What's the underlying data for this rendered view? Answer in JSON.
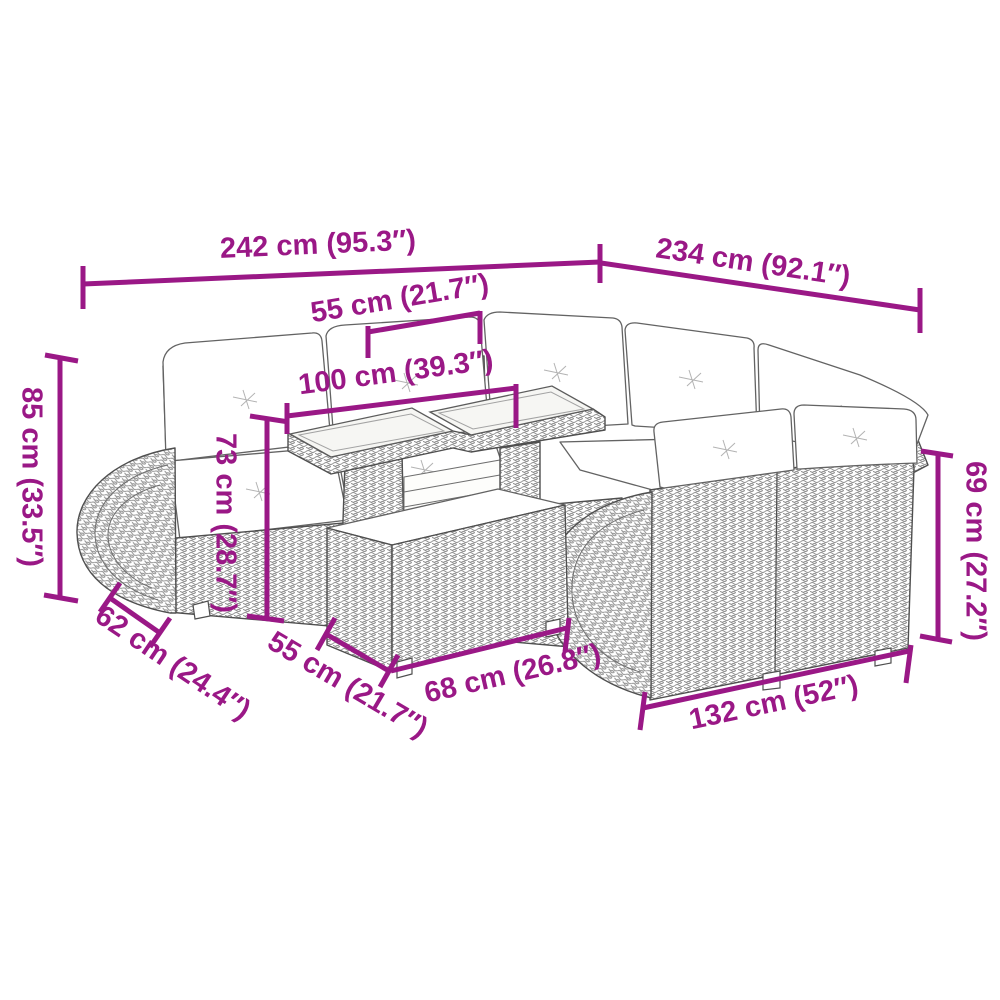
{
  "diagram": {
    "background_color": "#FFFFFF",
    "dimension_color": "#9A1886",
    "artwork_line_color": "#4F4F4F",
    "subject": "garden-corner-sofa-set-with-table-and-storage-box"
  },
  "dimensions": {
    "back_left_width": {
      "label": "242 cm (95.3″)"
    },
    "back_right_width": {
      "label": "234 cm (92.1″)"
    },
    "table_top_depth": {
      "label": "55 cm (21.7″)"
    },
    "table_top_width": {
      "label": "100 cm (39.3″)"
    },
    "sofa_height": {
      "label": "85 cm (33.5″)"
    },
    "table_height": {
      "label": "73 cm (28.7″)"
    },
    "right_sofa_height": {
      "label": "69 cm (27.2″)"
    },
    "left_sofa_depth": {
      "label": "62 cm (24.4″)"
    },
    "box_depth": {
      "label": "55 cm (21.7″)"
    },
    "box_width": {
      "label": "68 cm (26.8″)"
    },
    "right_sofa_width": {
      "label": "132 cm (52″)"
    }
  }
}
